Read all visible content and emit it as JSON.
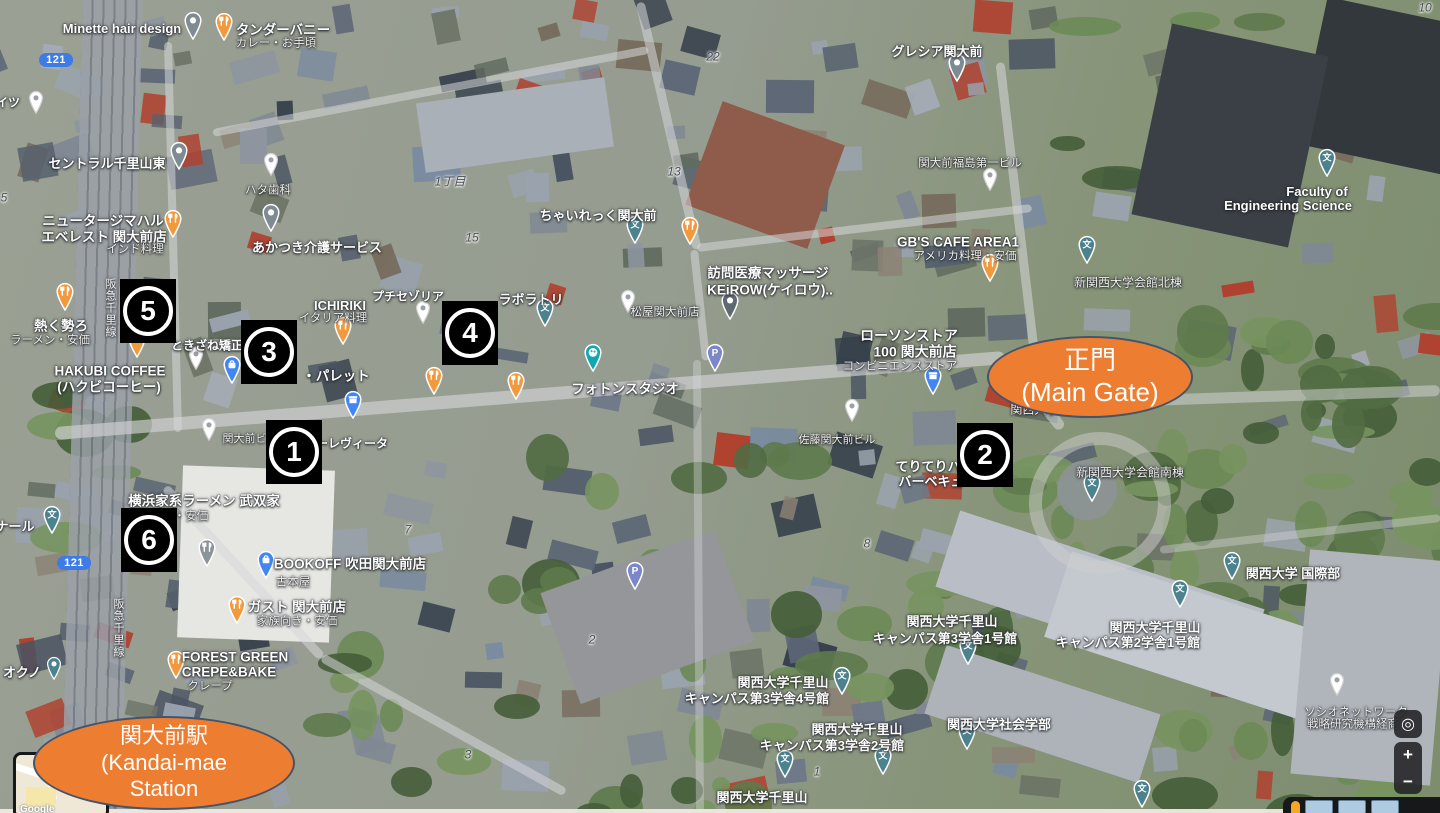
{
  "app": "satellite-map-with-annotations",
  "colors": {
    "annotation_orange": "#ED7D31",
    "annotation_border": "#44546A",
    "marker_bg": "#000000",
    "marker_fg": "#FFFFFF",
    "pin_food": "#F2993E",
    "pin_grey": "#7E8B92",
    "pin_dark": "#5E6A70",
    "pin_school": "#4C828E",
    "pin_blue": "#4285F4",
    "pin_parking": "#7B87C9",
    "pin_palette": "#0FA8B0",
    "route_shield_blue": "#3D7BE5"
  },
  "annotations": [
    {
      "id": "main-gate",
      "x": 1088,
      "y": 375,
      "rx": 101,
      "ry": 39,
      "fs": 26,
      "lines": [
        "正門",
        "(Main Gate)"
      ]
    },
    {
      "id": "station",
      "x": 162,
      "y": 761,
      "rx": 129,
      "ry": 45,
      "fs": 22,
      "lines": [
        "関大前駅",
        "(Kandai-mae",
        "Station"
      ]
    }
  ],
  "markers": [
    {
      "n": "1",
      "x": 294,
      "y": 452
    },
    {
      "n": "2",
      "x": 985,
      "y": 455
    },
    {
      "n": "3",
      "x": 269,
      "y": 352
    },
    {
      "n": "4",
      "x": 470,
      "y": 333
    },
    {
      "n": "5",
      "x": 148,
      "y": 311
    },
    {
      "n": "6",
      "x": 149,
      "y": 540
    }
  ],
  "route_shields": [
    {
      "label": "121",
      "x": 56,
      "y": 60
    },
    {
      "label": "121",
      "x": 74,
      "y": 563
    }
  ],
  "labels": [
    {
      "t": "Minette hair design",
      "x": 122,
      "y": 29,
      "s": 13,
      "st": "w"
    },
    {
      "t": "タンダーバニー",
      "x": 283,
      "y": 31,
      "s": 13.5,
      "st": "w"
    },
    {
      "t": "カレー・お手頃",
      "x": 276,
      "y": 44,
      "s": 11.5,
      "st": "ws"
    },
    {
      "t": "イツ",
      "x": 8,
      "y": 103,
      "s": 12,
      "st": "w"
    },
    {
      "t": "セントラル千里山東",
      "x": 107,
      "y": 164,
      "s": 13,
      "st": "w"
    },
    {
      "t": "ハタ歯科",
      "x": 268,
      "y": 191,
      "s": 11.5,
      "st": "ws"
    },
    {
      "t": "1丁目",
      "x": 450,
      "y": 182,
      "s": 12,
      "st": "d"
    },
    {
      "t": "ニュータージマハル",
      "x": 103,
      "y": 222,
      "s": 13.5,
      "st": "w"
    },
    {
      "t": "エベレスト 関大前店",
      "x": 104,
      "y": 238,
      "s": 13.5,
      "st": "w"
    },
    {
      "t": "インド料理",
      "x": 135,
      "y": 250,
      "s": 11.5,
      "st": "ws"
    },
    {
      "t": "あかつき介護サービス",
      "x": 317,
      "y": 248,
      "s": 13,
      "st": "w"
    },
    {
      "t": "グレシア関大前",
      "x": 937,
      "y": 52,
      "s": 13,
      "st": "w"
    },
    {
      "t": "関大前福島第一ビル",
      "x": 970,
      "y": 164,
      "s": 11.5,
      "st": "ws"
    },
    {
      "t": "ちゃいれっく関大前",
      "x": 598,
      "y": 216,
      "s": 13,
      "st": "w"
    },
    {
      "t": "Faculty of",
      "x": 1317,
      "y": 192,
      "s": 13,
      "st": "w"
    },
    {
      "t": "Engineering Science",
      "x": 1288,
      "y": 206,
      "s": 13,
      "st": "w"
    },
    {
      "t": "GB'S CAFE AREA1",
      "x": 958,
      "y": 243,
      "s": 13.5,
      "st": "w"
    },
    {
      "t": "アメリカ料理・安価",
      "x": 965,
      "y": 257,
      "s": 11.5,
      "st": "ws"
    },
    {
      "t": "訪問医療マッサージ",
      "x": 768,
      "y": 274,
      "s": 13.5,
      "st": "w"
    },
    {
      "t": "KEiROW(ケイロウ)..",
      "x": 770,
      "y": 291,
      "s": 13.5,
      "st": "w"
    },
    {
      "t": "新関西大学会館北棟",
      "x": 1128,
      "y": 283,
      "s": 12,
      "st": "ws"
    },
    {
      "t": "熱く勢ろ",
      "x": 61,
      "y": 327,
      "s": 13.5,
      "st": "w"
    },
    {
      "t": "ラーメン・安価",
      "x": 50,
      "y": 341,
      "s": 11.5,
      "st": "ws"
    },
    {
      "t": "ICHIRIKI",
      "x": 340,
      "y": 306,
      "s": 13,
      "st": "w"
    },
    {
      "t": "イタリア料理",
      "x": 333,
      "y": 319,
      "s": 11.5,
      "st": "ws"
    },
    {
      "t": "プチセゾリア",
      "x": 408,
      "y": 297,
      "s": 12,
      "st": "w"
    },
    {
      "t": "ラボラトリ",
      "x": 531,
      "y": 300,
      "s": 13,
      "st": "w"
    },
    {
      "t": "ときざね矯正歯",
      "x": 213,
      "y": 346,
      "s": 12,
      "st": "w"
    },
    {
      "t": "・パレット",
      "x": 336,
      "y": 377,
      "s": 13.5,
      "st": "w"
    },
    {
      "t": "HAKUBI COFFEE",
      "x": 110,
      "y": 372,
      "s": 13.5,
      "st": "w"
    },
    {
      "t": "(ハクビコーヒー)",
      "x": 109,
      "y": 388,
      "s": 13.5,
      "st": "w"
    },
    {
      "t": "松屋関大前店",
      "x": 665,
      "y": 313,
      "s": 11.5,
      "st": "ws"
    },
    {
      "t": "ローソンストア",
      "x": 909,
      "y": 336,
      "s": 14,
      "st": "w"
    },
    {
      "t": "100 関大前店",
      "x": 915,
      "y": 352,
      "s": 14,
      "st": "w"
    },
    {
      "t": "コンビニエンスストア",
      "x": 900,
      "y": 367,
      "s": 11.5,
      "st": "ws"
    },
    {
      "t": "フォトンスタジオ",
      "x": 625,
      "y": 390,
      "s": 13.5,
      "st": "w"
    },
    {
      "t": "関大前ビル",
      "x": 250,
      "y": 439,
      "s": 11,
      "st": "ws"
    },
    {
      "t": "ーレヴィータ",
      "x": 352,
      "y": 444,
      "s": 12,
      "st": "w"
    },
    {
      "t": "関西大学 正門",
      "x": 1048,
      "y": 410,
      "s": 12,
      "st": "ws"
    },
    {
      "t": "佐藤関大前ビル",
      "x": 837,
      "y": 440,
      "s": 11,
      "st": "ws"
    },
    {
      "t": "てりてりハ",
      "x": 928,
      "y": 467,
      "s": 13,
      "st": "w"
    },
    {
      "t": "バーベキュ",
      "x": 931,
      "y": 482,
      "s": 13,
      "st": "w"
    },
    {
      "t": "新関西大学会館南棟",
      "x": 1130,
      "y": 473,
      "s": 12,
      "st": "ws"
    },
    {
      "t": "横浜家系ラーメン 武双家",
      "x": 204,
      "y": 502,
      "s": 13.5,
      "st": "w"
    },
    {
      "t": "・安価",
      "x": 191,
      "y": 517,
      "s": 11.5,
      "st": "ws"
    },
    {
      "t": "ナール",
      "x": 15,
      "y": 527,
      "s": 13,
      "st": "w"
    },
    {
      "t": "オクノ",
      "x": 22,
      "y": 673,
      "s": 13,
      "st": "w"
    },
    {
      "t": "BOOKOFF 吹田関大前店",
      "x": 350,
      "y": 565,
      "s": 13.5,
      "st": "w"
    },
    {
      "t": "古本屋",
      "x": 293,
      "y": 583,
      "s": 11.5,
      "st": "ws"
    },
    {
      "t": "ガスト 関大前店",
      "x": 297,
      "y": 608,
      "s": 13.5,
      "st": "w"
    },
    {
      "t": "家族向き・安価",
      "x": 297,
      "y": 622,
      "s": 11.5,
      "st": "ws"
    },
    {
      "t": "FOREST GREEN",
      "x": 235,
      "y": 658,
      "s": 13.5,
      "st": "w"
    },
    {
      "t": "CREPE&BAKE",
      "x": 229,
      "y": 673,
      "s": 13.5,
      "st": "w"
    },
    {
      "t": "クレープ",
      "x": 210,
      "y": 687,
      "s": 11.5,
      "st": "ws"
    },
    {
      "t": "関西大学千里山",
      "x": 952,
      "y": 622,
      "s": 13,
      "st": "w"
    },
    {
      "t": "キャンパス第3学舎1号館",
      "x": 945,
      "y": 639,
      "s": 13,
      "st": "w"
    },
    {
      "t": "関西大学千里山",
      "x": 783,
      "y": 683,
      "s": 13,
      "st": "w"
    },
    {
      "t": "キャンパス第3学舎4号館",
      "x": 757,
      "y": 699,
      "s": 13,
      "st": "w"
    },
    {
      "t": "関西大学千里山",
      "x": 857,
      "y": 730,
      "s": 13,
      "st": "w"
    },
    {
      "t": "キャンパス第3学舎2号館",
      "x": 832,
      "y": 746,
      "s": 13,
      "st": "w"
    },
    {
      "t": "関西大学千里山",
      "x": 762,
      "y": 798,
      "s": 13,
      "st": "w"
    },
    {
      "t": "関西大学 国際部",
      "x": 1293,
      "y": 574,
      "s": 13,
      "st": "w"
    },
    {
      "t": "関西大学千里山",
      "x": 1155,
      "y": 628,
      "s": 13,
      "st": "w"
    },
    {
      "t": "キャンパス第2学舎1号館",
      "x": 1128,
      "y": 643,
      "s": 13,
      "st": "w"
    },
    {
      "t": "関西大学社会学部",
      "x": 999,
      "y": 725,
      "s": 13,
      "st": "w"
    },
    {
      "t": "ソシオネットワーク",
      "x": 1356,
      "y": 713,
      "s": 11.5,
      "st": "ws"
    },
    {
      "t": "戦略研究機構経商",
      "x": 1353,
      "y": 725,
      "s": 11.5,
      "st": "ws"
    },
    {
      "t": "コンビニエンスストア",
      "x": 157,
      "y": 803,
      "s": 11.5,
      "st": "ws"
    },
    {
      "t": "22",
      "x": 713,
      "y": 57,
      "s": 12,
      "st": "d"
    },
    {
      "t": "10",
      "x": 1425,
      "y": 8,
      "s": 12,
      "st": "d"
    },
    {
      "t": "13",
      "x": 674,
      "y": 172,
      "s": 12,
      "st": "d"
    },
    {
      "t": "15",
      "x": 472,
      "y": 238,
      "s": 12,
      "st": "d"
    },
    {
      "t": "5",
      "x": 4,
      "y": 198,
      "s": 12,
      "st": "d"
    },
    {
      "t": "7",
      "x": 408,
      "y": 530,
      "s": 12,
      "st": "d"
    },
    {
      "t": "2",
      "x": 592,
      "y": 640,
      "s": 12,
      "st": "d"
    },
    {
      "t": "8",
      "x": 867,
      "y": 544,
      "s": 12,
      "st": "d"
    },
    {
      "t": "3",
      "x": 468,
      "y": 755,
      "s": 12,
      "st": "d"
    },
    {
      "t": "1",
      "x": 817,
      "y": 772,
      "s": 12,
      "st": "d"
    },
    {
      "t": "阪急千里線",
      "x": 110,
      "y": 308,
      "s": 11,
      "st": "v"
    },
    {
      "t": "阪急千里線",
      "x": 118,
      "y": 628,
      "s": 11,
      "st": "v"
    }
  ],
  "pins": [
    {
      "k": "food",
      "x": 224,
      "y": 46
    },
    {
      "k": "food",
      "x": 173,
      "y": 243
    },
    {
      "k": "food",
      "x": 65,
      "y": 316
    },
    {
      "k": "food",
      "x": 137,
      "y": 363
    },
    {
      "k": "food",
      "x": 343,
      "y": 350
    },
    {
      "k": "food",
      "x": 434,
      "y": 400
    },
    {
      "k": "food",
      "x": 516,
      "y": 405
    },
    {
      "k": "food",
      "x": 690,
      "y": 250
    },
    {
      "k": "food",
      "x": 990,
      "y": 287
    },
    {
      "k": "food",
      "x": 237,
      "y": 629
    },
    {
      "k": "food",
      "x": 176,
      "y": 684
    },
    {
      "k": "grey",
      "x": 193,
      "y": 45
    },
    {
      "k": "grey",
      "x": 179,
      "y": 175
    },
    {
      "k": "grey",
      "x": 271,
      "y": 237
    },
    {
      "k": "grey",
      "x": 957,
      "y": 87
    },
    {
      "k": "dark",
      "x": 730,
      "y": 325
    },
    {
      "k": "greyfood",
      "x": 207,
      "y": 572
    },
    {
      "k": "white",
      "x": 36,
      "y": 119
    },
    {
      "k": "white",
      "x": 271,
      "y": 181
    },
    {
      "k": "white",
      "x": 423,
      "y": 329
    },
    {
      "k": "white",
      "x": 196,
      "y": 375
    },
    {
      "k": "white",
      "x": 628,
      "y": 318
    },
    {
      "k": "white",
      "x": 209,
      "y": 446
    },
    {
      "k": "white",
      "x": 852,
      "y": 427
    },
    {
      "k": "white",
      "x": 990,
      "y": 196
    },
    {
      "k": "white",
      "x": 1337,
      "y": 701
    },
    {
      "k": "bag",
      "x": 232,
      "y": 389
    },
    {
      "k": "bag",
      "x": 266,
      "y": 584
    },
    {
      "k": "conv",
      "x": 353,
      "y": 424
    },
    {
      "k": "conv",
      "x": 933,
      "y": 400
    },
    {
      "k": "parking",
      "x": 715,
      "y": 377
    },
    {
      "k": "parking",
      "x": 635,
      "y": 595
    },
    {
      "k": "school",
      "x": 635,
      "y": 249
    },
    {
      "k": "school",
      "x": 545,
      "y": 332
    },
    {
      "k": "school",
      "x": 52,
      "y": 539
    },
    {
      "k": "school",
      "x": 1092,
      "y": 507
    },
    {
      "k": "school",
      "x": 842,
      "y": 700
    },
    {
      "k": "school",
      "x": 883,
      "y": 780
    },
    {
      "k": "school",
      "x": 785,
      "y": 783
    },
    {
      "k": "school",
      "x": 1232,
      "y": 585
    },
    {
      "k": "school",
      "x": 1180,
      "y": 613
    },
    {
      "k": "school",
      "x": 968,
      "y": 670
    },
    {
      "k": "school",
      "x": 967,
      "y": 755
    },
    {
      "k": "school",
      "x": 1327,
      "y": 182
    },
    {
      "k": "school",
      "x": 1087,
      "y": 269
    },
    {
      "k": "school",
      "x": 1142,
      "y": 813
    },
    {
      "k": "palette",
      "x": 593,
      "y": 377
    },
    {
      "k": "tealdot",
      "x": 54,
      "y": 685
    }
  ],
  "controls": {
    "zoom_in": "+",
    "zoom_out": "−",
    "locate": "◎"
  },
  "inset": {
    "google_label": "Google"
  }
}
